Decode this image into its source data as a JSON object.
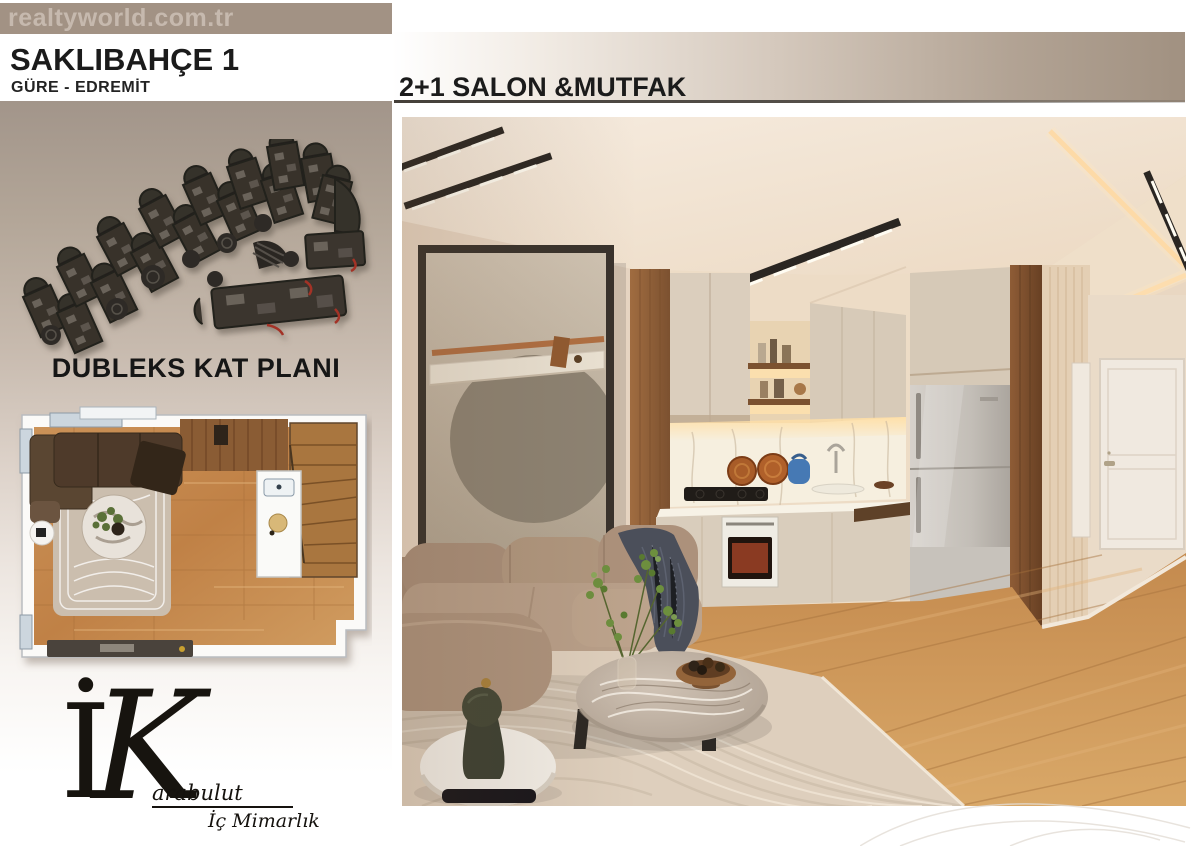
{
  "watermark": {
    "text": "realtyworld.com.tr"
  },
  "project": {
    "title": "SAKLIBAHÇE 1",
    "location": "GÜRE - EDREMİT"
  },
  "floor_plan": {
    "caption": "DUBLEKS KAT PLANI"
  },
  "main": {
    "heading": "2+1 SALON &MUTFAK"
  },
  "logo": {
    "monogram_i": "İ",
    "monogram_k": "K",
    "name": "arabulut",
    "tagline": "İç Mimarlık"
  },
  "colors": {
    "top_bar": "#a29284",
    "watermark_text": "#c6b9ae",
    "band": "#a19181",
    "underline": "#55504a",
    "ink": "#1b1b1b"
  }
}
